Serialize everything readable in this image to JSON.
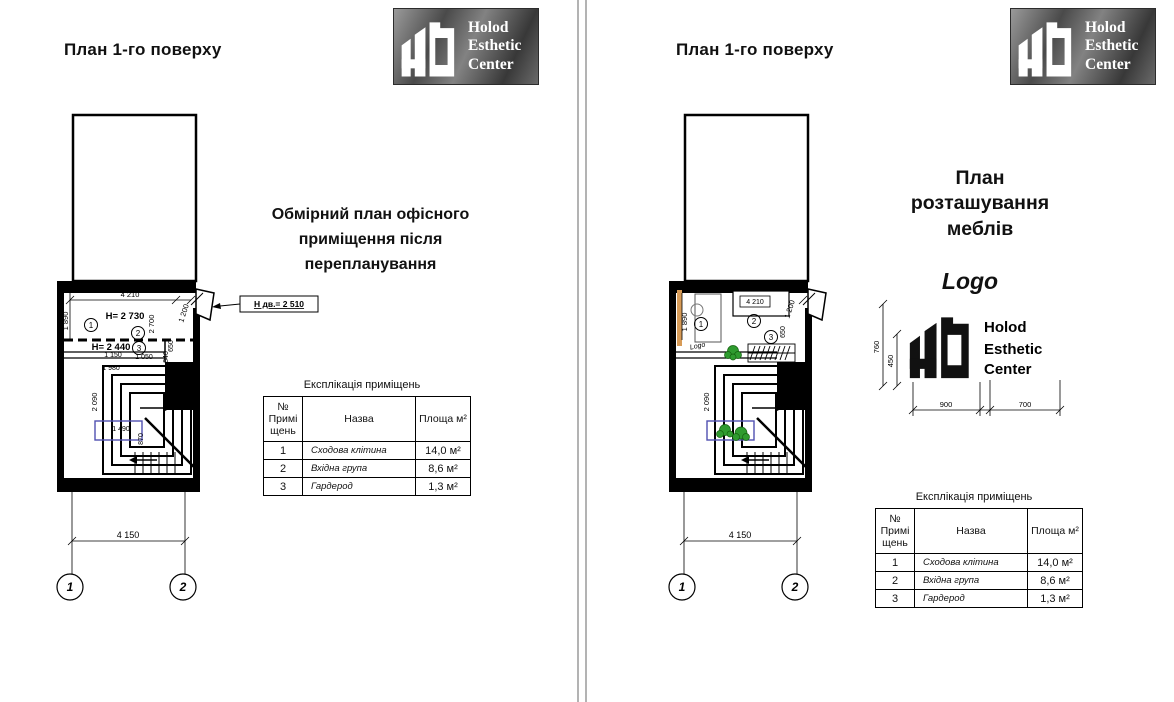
{
  "brand": {
    "line1": "Holod",
    "line2": "Esthetic",
    "line3": "Center"
  },
  "left_page": {
    "title": "План 1-го поверху",
    "note1": "Обмірний план офісного",
    "note2": "приміщення після",
    "note3": "перепланування",
    "callout": "Н дв.= 2 510",
    "dims": {
      "top": "4 210",
      "right_top": "1 200",
      "left_top": "1 890",
      "h1": "H= 2 730",
      "v2700": "2 700",
      "v650": "650",
      "h2": "H= 2 440",
      "d1150": "1 150",
      "d1050": "1 050",
      "d840": "840",
      "d1980": "1 980",
      "d3850": "3 850",
      "d2090": "2 090",
      "d1490": "1 490",
      "d870": "870",
      "bottom": "4 150"
    },
    "rooms": {
      "r1": "1",
      "r2": "2",
      "r3": "3"
    },
    "axes": {
      "a1": "1",
      "a2": "2"
    }
  },
  "right_page": {
    "title": "План 1-го поверху",
    "heading1": "План",
    "heading2": "розташування",
    "heading3": "меблів",
    "logo_caption": "Logo",
    "plan_logo_label": "Logo",
    "dims": {
      "sofa": "4 210",
      "right_top": "1 200",
      "left_top": "1 890",
      "v650": "650",
      "d2090": "2 090",
      "bottom": "4 150"
    },
    "rooms": {
      "r1": "1",
      "r2": "2",
      "r3": "3"
    },
    "axes": {
      "a1": "1",
      "a2": "2"
    },
    "logo_dims": {
      "v760": "760",
      "v450": "450",
      "h900": "900",
      "h700": "700"
    }
  },
  "table": {
    "title": "Експлікація приміщень",
    "col_no": "№ Примі щень",
    "col_name": "Назва",
    "col_area": "Площа м²",
    "rows": [
      {
        "no": "1",
        "name": "Сходова клітина",
        "area": "14,0 м²"
      },
      {
        "no": "2",
        "name": "Вхідна група",
        "area": "8,6 м²"
      },
      {
        "no": "3",
        "name": "Гардерод",
        "area": "1,3 м²"
      }
    ]
  }
}
